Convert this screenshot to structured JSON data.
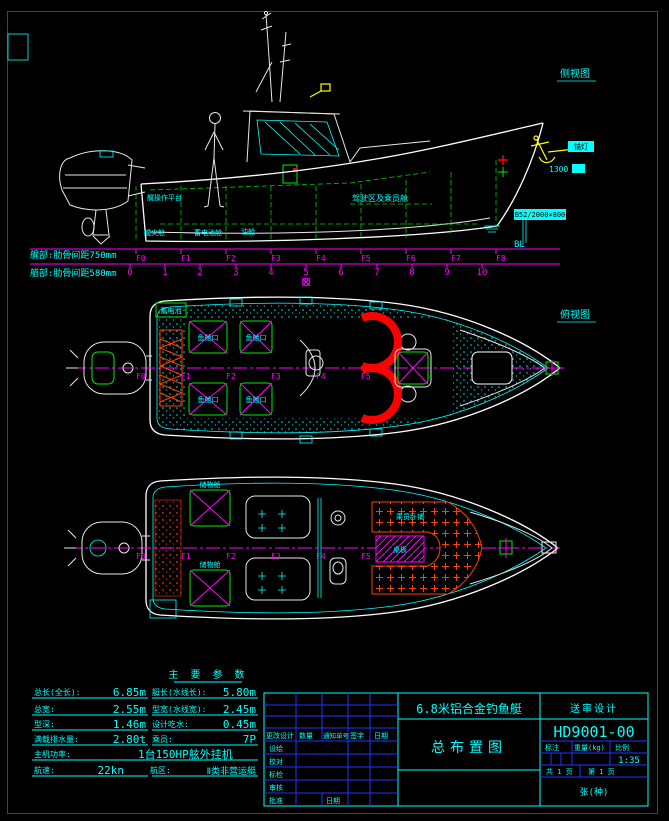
{
  "colors": {
    "background": "#000000",
    "border_blue": "#2233ff",
    "line_cyan": "#00ffff",
    "line_magenta": "#ff00ff",
    "line_green": "#00ee00",
    "line_white": "#ffffff",
    "line_red": "#ff0000",
    "hatch_orange": "#ff4000",
    "accent_yellow": "#ffff00"
  },
  "drawing": {
    "side_view_label": "侧视图",
    "plan_view_label": "俯视图",
    "note_aft": "艉部:肋骨间距750mm",
    "note_fwd": "艏部:肋骨间距580mm",
    "baseline_label": "BL",
    "frames": [
      "F0",
      "F1",
      "F2",
      "F3",
      "F4",
      "F5",
      "F6",
      "F7",
      "F8"
    ],
    "stations": [
      "0",
      "1",
      "2",
      "3",
      "4",
      "5",
      "6",
      "7",
      "8",
      "9",
      "10"
    ],
    "side": {
      "cabin": "驾驶区及乘员舱",
      "platform": "艉操作平台",
      "comp1": "艉尖舱",
      "comp2": "蓄电池舱",
      "comp3": "油舱",
      "anchor_light": "锚灯",
      "bow_dim": "1300",
      "anchor_spec": "B52/2000×800"
    },
    "plan1": {
      "battery": "蓄电池",
      "hatch": "鱼舱口"
    },
    "plan2": {
      "berth": "乘员卧铺",
      "table": "桌板",
      "locker": "储物舱"
    }
  },
  "spec_table": {
    "title": "主 要 参 数",
    "rows": [
      {
        "l_label": "总长(全长):",
        "l_value": "6.85m",
        "r_label": "艇长(水线长):",
        "r_value": "5.80m"
      },
      {
        "l_label": "总宽:",
        "l_value": "2.55m",
        "r_label": "型宽(水线宽):",
        "r_value": "2.45m"
      },
      {
        "l_label": "型深:",
        "l_value": "1.46m",
        "r_label": "设计吃水:",
        "r_value": "0.45m"
      },
      {
        "l_label": "满载排水量:",
        "l_value": "2.80t",
        "r_label": "乘员:",
        "r_value": "7P"
      },
      {
        "l_label": "主机功率:",
        "l_value": "1台150HP舷外挂机",
        "r_label": "",
        "r_value": ""
      },
      {
        "l_label": "航速:",
        "l_value": "22kn",
        "r_label": "航区:",
        "r_value": "Ⅱ类非营运艇"
      }
    ]
  },
  "title_block": {
    "product": "6.8米铝合金钓鱼艇",
    "stage": "送审设计",
    "drawing_no": "HD9001-00",
    "drawing_title": "总布置图",
    "rev_header": {
      "change": "更改设计",
      "qty": "数量",
      "notice": "通知单号",
      "sign": "签字",
      "date": "日期"
    },
    "roles": [
      "设绘",
      "校对",
      "标检",
      "审核",
      "批准"
    ],
    "approve_date_label": "日期",
    "mark_label": "标注",
    "weight_label": "重量(kg)",
    "scale_label": "比例",
    "scale_value": "1:35",
    "pages_total": "共 1 页",
    "page_no": "第 1 页",
    "sheet_note": "张(种)"
  }
}
